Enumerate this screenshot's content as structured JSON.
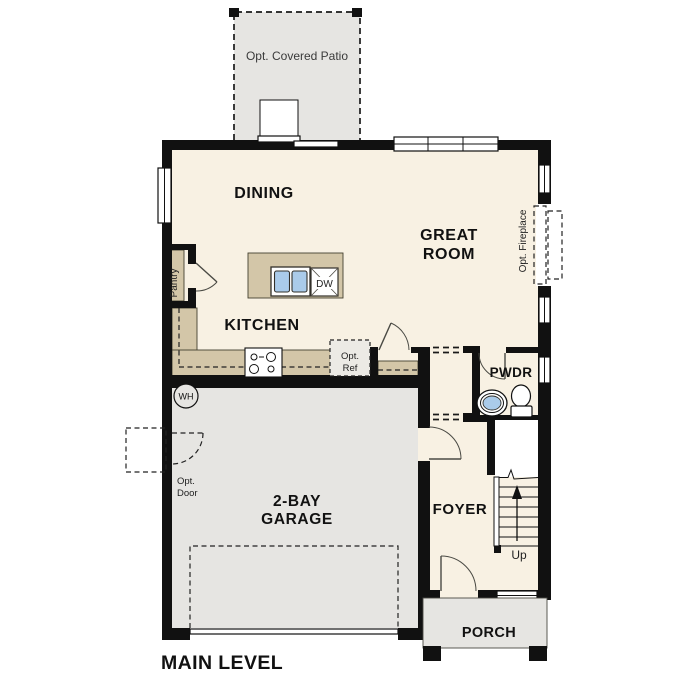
{
  "floor_plan": {
    "title": "MAIN LEVEL",
    "rooms": {
      "dining": "DINING",
      "great_room": [
        "GREAT",
        "ROOM"
      ],
      "kitchen": "KITCHEN",
      "garage": [
        "2-BAY",
        "GARAGE"
      ],
      "foyer": "FOYER",
      "powder_room": "PWDR",
      "porch": "PORCH"
    },
    "options": {
      "covered_patio": "Opt. Covered Patio",
      "fireplace": "Opt. Fireplace",
      "refrigerator": [
        "Opt.",
        "Ref"
      ],
      "garage_service_door": [
        "Opt.",
        "Door"
      ]
    },
    "fixtures": {
      "pantry": "Pantry",
      "dishwasher": "DW",
      "water_heater": "WH",
      "stair_direction": "Up"
    },
    "palette": {
      "wall": "#111111",
      "interior_floor": "#f8f1e3",
      "concrete": "#e6e5e2",
      "casework": "#d3c6a8",
      "plumbing_blue": "#aacbea",
      "background": "#ffffff",
      "text": "#111111"
    }
  }
}
